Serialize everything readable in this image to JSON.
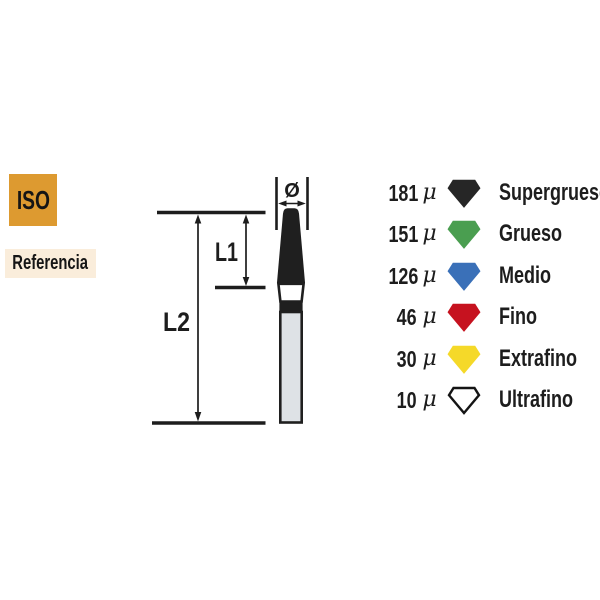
{
  "side_labels": {
    "iso": "ISO",
    "referencia": "Referencia",
    "iso_bg": "#dd9a30",
    "referencia_bg": "#faeddb"
  },
  "diagram": {
    "diameter_symbol": "Ø",
    "l1_label": "L1",
    "l2_label": "L2"
  },
  "legend": {
    "mu": "μ",
    "items": [
      {
        "microns": "181",
        "grade": "Supergrueso",
        "fill": "#262626",
        "stroke": "#262626"
      },
      {
        "microns": "151",
        "grade": "Grueso",
        "fill": "#4a9e50",
        "stroke": "#4a9e50"
      },
      {
        "microns": "126",
        "grade": "Medio",
        "fill": "#3a70b8",
        "stroke": "#3a70b8"
      },
      {
        "microns": "46",
        "grade": "Fino",
        "fill": "#c6121f",
        "stroke": "#c6121f"
      },
      {
        "microns": "30",
        "grade": "Extrafino",
        "fill": "#f5d929",
        "stroke": "#f5d929"
      },
      {
        "microns": "10",
        "grade": "Ultrafino",
        "fill": "#ffffff",
        "stroke": "#141414"
      }
    ]
  },
  "colors": {
    "ink": "#1d1d1d",
    "bur_tip": "#1f1f1f",
    "bur_shank": "#dee2e6"
  }
}
